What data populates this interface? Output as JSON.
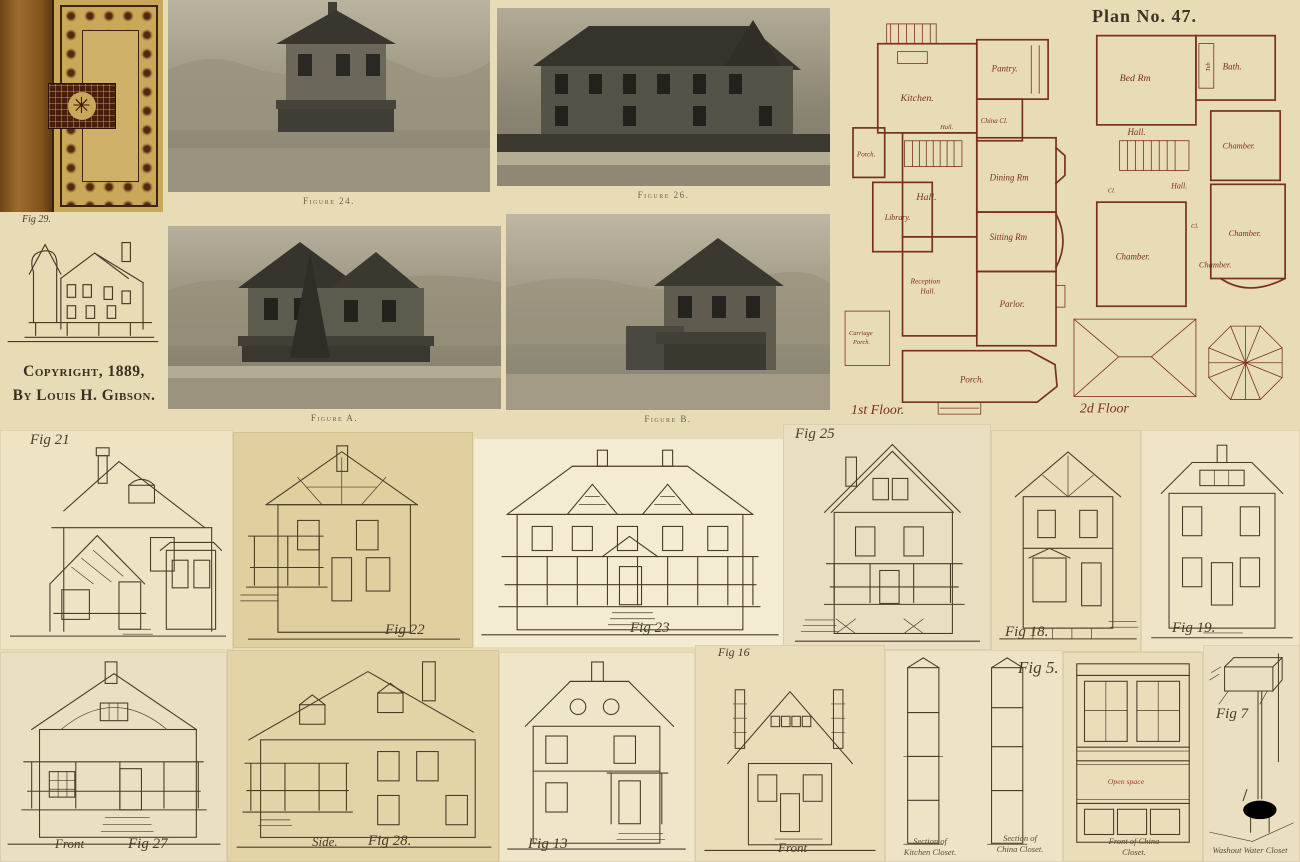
{
  "colors": {
    "canvas_bg": "#e7dcb5",
    "panel_light": "#f3ecd3",
    "panel_dark": "#e0cf9f",
    "ink": "#4a3b28",
    "plan_ink": "#7a2f1f",
    "accent_red": "#9c3b28",
    "photo_dark": "#35332b",
    "photo_light": "#bdb6a2",
    "cover_spine": "#845420",
    "cover_tan": "#c9a85a",
    "cover_medallion": "#4a1c0e"
  },
  "book": {
    "fig_label": "Fig 29.",
    "copyright_1": "Copyright, 1889,",
    "copyright_2": "By Louis H. Gibson."
  },
  "photos": {
    "fig24_caption": "Figure 24.",
    "fig26_caption": "Figure 26.",
    "figA_caption": "Figure A.",
    "figB_caption": "Figure B."
  },
  "plan": {
    "title": "Plan No. 47.",
    "first_floor_label": "1st Floor.",
    "second_floor_label": "2d Floor",
    "first_floor_rooms": {
      "porch_side": "Porch.",
      "kitchen": "Kitchen.",
      "pantry": "Pantry.",
      "china_closet": "China Cl.",
      "hall_main": "Hall.",
      "hall_back": "Hall.",
      "library": "Library.",
      "dining": "Dining Rm",
      "sitting": "Sitting Rm",
      "reception_l1": "Reception",
      "reception_l2": "Hall.",
      "parlor": "Parlor.",
      "carriage_l1": "Carriage",
      "carriage_l2": "Porch.",
      "porch_front": "Porch."
    },
    "second_floor_rooms": {
      "bed": "Bed Rm",
      "bath": "Bath.",
      "tub": "Tub",
      "hall_upper": "Hall.",
      "hall_lower": "Hall.",
      "closet1": "Cl.",
      "closet2": "Cl.",
      "chamber1": "Chamber.",
      "chamber2": "Chamber.",
      "chamber3": "Chamber.",
      "chamber4": "Chamber."
    }
  },
  "elevations": {
    "fig21": "Fig 21",
    "fig22": "Fig 22",
    "fig23": "Fig 23",
    "fig25": "Fig 25",
    "fig18": "Fig 18.",
    "fig19": "Fig 19.",
    "fig27": "Fig 27",
    "fig27_view": "Front",
    "fig28": "Fig 28.",
    "fig28_view": "Side.",
    "fig13": "Fig 13",
    "fig16": "Fig 16",
    "fig16_view": "Front",
    "fig5": "Fig 5.",
    "fig7": "Fig 7",
    "kitchen_section_l1": "Section of",
    "kitchen_section_l2": "Kitchen Closet.",
    "china_section_l1": "Section of",
    "china_section_l2": "China Closet.",
    "china_front_l1": "Front of China",
    "china_front_l2": "Closet.",
    "china_open_space": "Open space",
    "water_closet_caption": "Washout Water Closet"
  }
}
